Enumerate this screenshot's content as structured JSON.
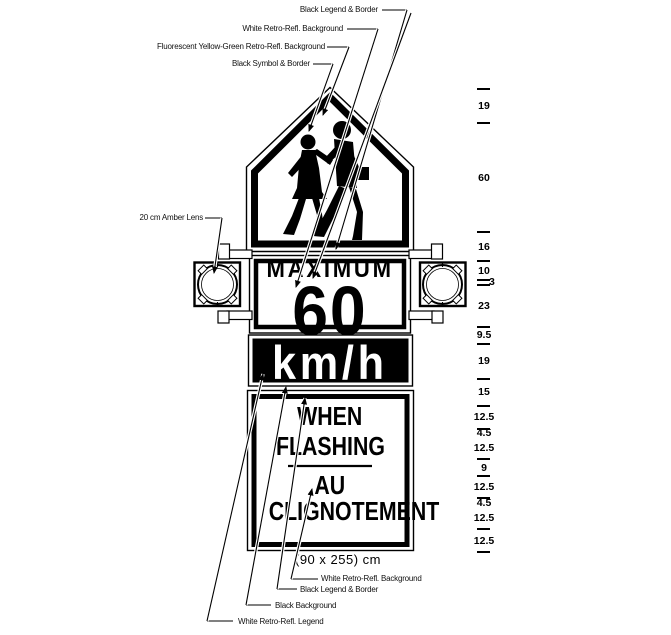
{
  "labels": {
    "top": [
      "Black Legend & Border",
      "White Retro-Refl. Background",
      "Fluorescent Yellow-Green Retro-Refl. Background",
      "Black Symbol & Border"
    ],
    "left": "20 cm Amber Lens",
    "bottom": [
      "White Retro-Refl. Background",
      "Black Legend & Border",
      "Black Background",
      "White Retro-Refl. Legend"
    ],
    "size_note": "(90 x 255) cm"
  },
  "sign": {
    "speed_panel": {
      "word": "MAXIMUM",
      "value": "60"
    },
    "unit_panel": {
      "text": "km/h"
    },
    "flash_lines": [
      "WHEN",
      "FLASHING",
      "AU",
      "CLIGNOTEMENT"
    ]
  },
  "dimensions_cm": {
    "segments": [
      19,
      60,
      16,
      10,
      3,
      23,
      9.5,
      19,
      15,
      12.5,
      4.5,
      12.5,
      9,
      12.5,
      4.5,
      12.5,
      12.5
    ],
    "total": 255,
    "width": 90
  },
  "colors": {
    "ink": "#000000",
    "paper": "#ffffff"
  }
}
